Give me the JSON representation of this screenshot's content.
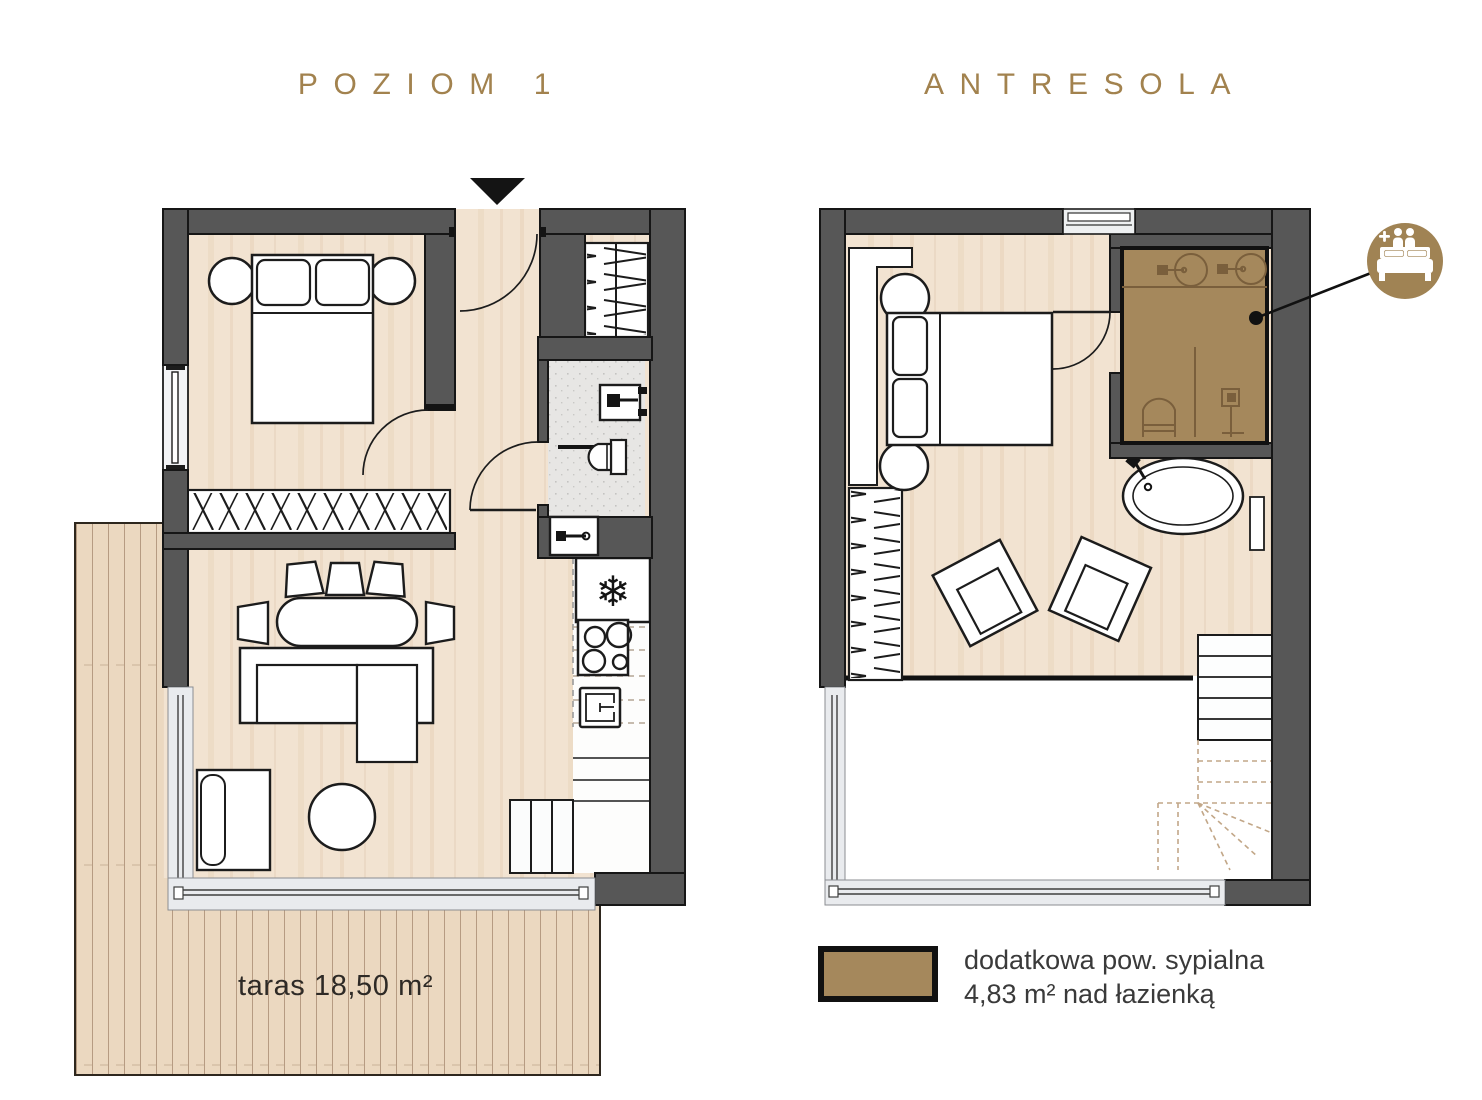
{
  "header": {
    "left_title": "POZIOM 1",
    "right_title": "ANTRESOLA"
  },
  "plan_level1": {
    "terrace_label": "taras 18,50 m²"
  },
  "legend": {
    "swatch_color": "#a5885c",
    "line1": "dodatkowa pow. sypialna",
    "line2": "4,83 m² nad łazienką"
  },
  "icons": {
    "snowflake": "❄"
  },
  "colors": {
    "wall_gray": "#575757",
    "outline_black": "#161616",
    "floor_wood": "#f2e3d1",
    "terrace_wood": "#ebd8c0",
    "bathroom_tile": "#e7e6e4",
    "overlay_brown": "#a5885c",
    "overlay_brown_line": "#7a5f3c",
    "glass_gray": "#e9ebee",
    "accent_gold_title": "#a2824e",
    "icon_gold": "#a08354"
  }
}
